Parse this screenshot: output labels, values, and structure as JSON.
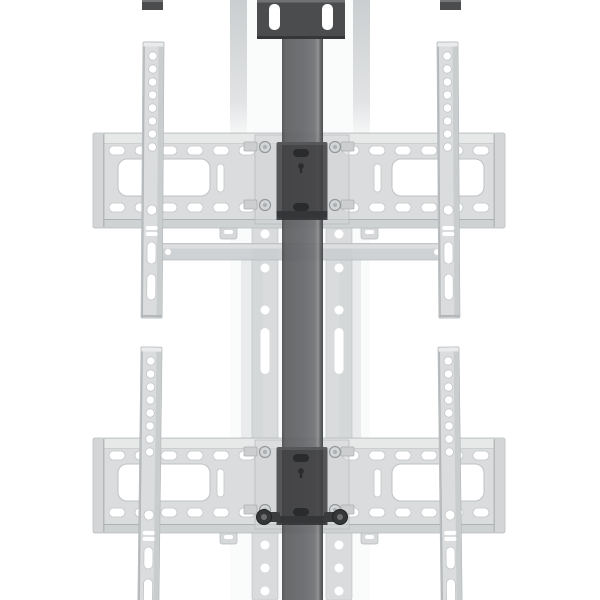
{
  "image": {
    "kind": "product-render",
    "text_content": []
  },
  "colors": {
    "background": "#ffffff",
    "column": "#656669",
    "column_edge_dark": "#3e3f41",
    "column_highlight": "#898b8d",
    "dark_plate": "#4b4c4e",
    "dark_fitting": "#353638",
    "ghost_face": "#dadcdd",
    "ghost_face_light": "#e7e9e9",
    "ghost_edge": "#b6babc",
    "ghost_medium": "#cfd2d3",
    "ghost_faint": "#e9ebec",
    "hole": "#ffffff"
  },
  "parts": [
    {
      "name": "center-column",
      "shade": "dark-gray"
    },
    {
      "name": "top-mounting-plate",
      "shade": "dark-gray"
    },
    {
      "name": "left-rail-end-cap",
      "shade": "dark-gray"
    },
    {
      "name": "right-rail-end-cap",
      "shade": "dark-gray"
    },
    {
      "name": "upper-wall-plate",
      "shade": "ghost-light-gray"
    },
    {
      "name": "lower-wall-plate",
      "shade": "ghost-light-gray"
    },
    {
      "name": "upper-left-vesa-rail",
      "shade": "ghost-light-gray"
    },
    {
      "name": "upper-right-vesa-rail",
      "shade": "ghost-light-gray"
    },
    {
      "name": "lower-left-vesa-rail",
      "shade": "ghost-light-gray"
    },
    {
      "name": "lower-right-vesa-rail",
      "shade": "ghost-light-gray"
    },
    {
      "name": "cross-support-bar",
      "shade": "ghost-light-gray"
    },
    {
      "name": "left-adapter-strip",
      "shade": "ghost-light-gray"
    },
    {
      "name": "right-adapter-strip",
      "shade": "ghost-light-gray"
    },
    {
      "name": "upper-column-bracket",
      "shade": "dark-gray"
    },
    {
      "name": "lower-column-bracket",
      "shade": "dark-gray"
    },
    {
      "name": "left-shoulder-bolt",
      "shade": "dark-gray"
    },
    {
      "name": "right-shoulder-bolt",
      "shade": "dark-gray"
    }
  ]
}
